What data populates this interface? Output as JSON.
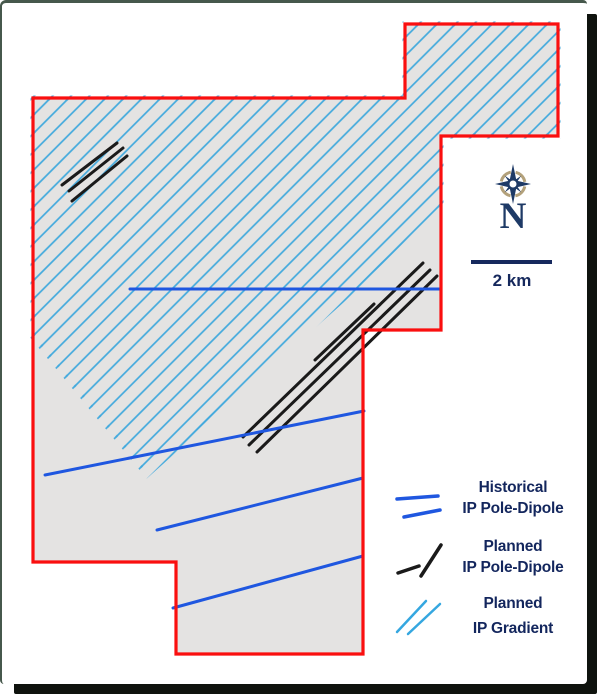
{
  "map": {
    "region_fill": "#e4e3e2",
    "boundary_color": "#fa0f0f",
    "claim_boundary": [
      [
        33,
        98
      ],
      [
        405,
        98
      ],
      [
        405,
        24
      ],
      [
        558,
        24
      ],
      [
        558,
        136
      ],
      [
        441,
        136
      ],
      [
        441,
        330
      ],
      [
        363,
        330
      ],
      [
        363,
        654
      ],
      [
        176,
        654
      ],
      [
        176,
        562
      ],
      [
        33,
        562
      ]
    ],
    "gradient_area": {
      "hatch_color": "#41a9dd",
      "hatch_spacing_px": 13,
      "polygon": [
        [
          33,
          98
        ],
        [
          405,
          98
        ],
        [
          405,
          24
        ],
        [
          558,
          24
        ],
        [
          558,
          136
        ],
        [
          441,
          136
        ],
        [
          441,
          212
        ],
        [
          147,
          475
        ],
        [
          33,
          337
        ]
      ]
    },
    "historical_lines": {
      "color": "#1f57e0",
      "lines": [
        [
          130,
          289,
          441,
          289
        ],
        [
          45,
          475,
          364,
          411
        ],
        [
          157,
          530,
          363,
          478
        ],
        [
          173,
          608,
          363,
          556
        ]
      ]
    },
    "planned_lines": {
      "color": "#1a1a1a",
      "lines": [
        [
          243,
          437,
          423,
          263
        ],
        [
          249,
          445,
          430,
          270
        ],
        [
          257,
          452,
          437,
          276
        ],
        [
          315,
          360,
          374,
          304
        ],
        [
          62,
          185,
          117,
          143
        ],
        [
          69,
          191,
          123,
          148
        ],
        [
          72,
          201,
          127,
          156
        ]
      ]
    }
  },
  "compass": {
    "north_label": "N",
    "star_color": "#1e3a66",
    "ring_color": "#b3a17b"
  },
  "scale_bar": {
    "label": "2 km",
    "color": "#16295d",
    "x": 471,
    "y": 260,
    "length_px": 81
  },
  "legend": {
    "text_color": "#13265d",
    "items": [
      {
        "name": "historical-ip-pole-dipole",
        "icon": "historical-lines-icon",
        "line1": "Historical",
        "line2": "IP Pole-Dipole",
        "symbol_color": "#1f57e0",
        "symbol_width": 3.5,
        "symbol_lines": [
          [
            397,
            499,
            438,
            496
          ],
          [
            404,
            517,
            440,
            510
          ]
        ]
      },
      {
        "name": "planned-ip-pole-dipole",
        "icon": "planned-lines-icon",
        "line1": "Planned",
        "line2": "IP Pole-Dipole",
        "symbol_color": "#1a1a1a",
        "symbol_width": 3.5,
        "symbol_lines": [
          [
            398,
            573,
            419,
            566
          ],
          [
            421,
            576,
            441,
            545
          ]
        ]
      },
      {
        "name": "planned-ip-gradient",
        "icon": "gradient-lines-icon",
        "line1": "Planned",
        "line2": "IP Gradient",
        "symbol_color": "#35a7e0",
        "symbol_width": 2.5,
        "symbol_lines": [
          [
            397,
            632,
            426,
            601
          ],
          [
            408,
            634,
            440,
            604
          ]
        ]
      }
    ]
  }
}
